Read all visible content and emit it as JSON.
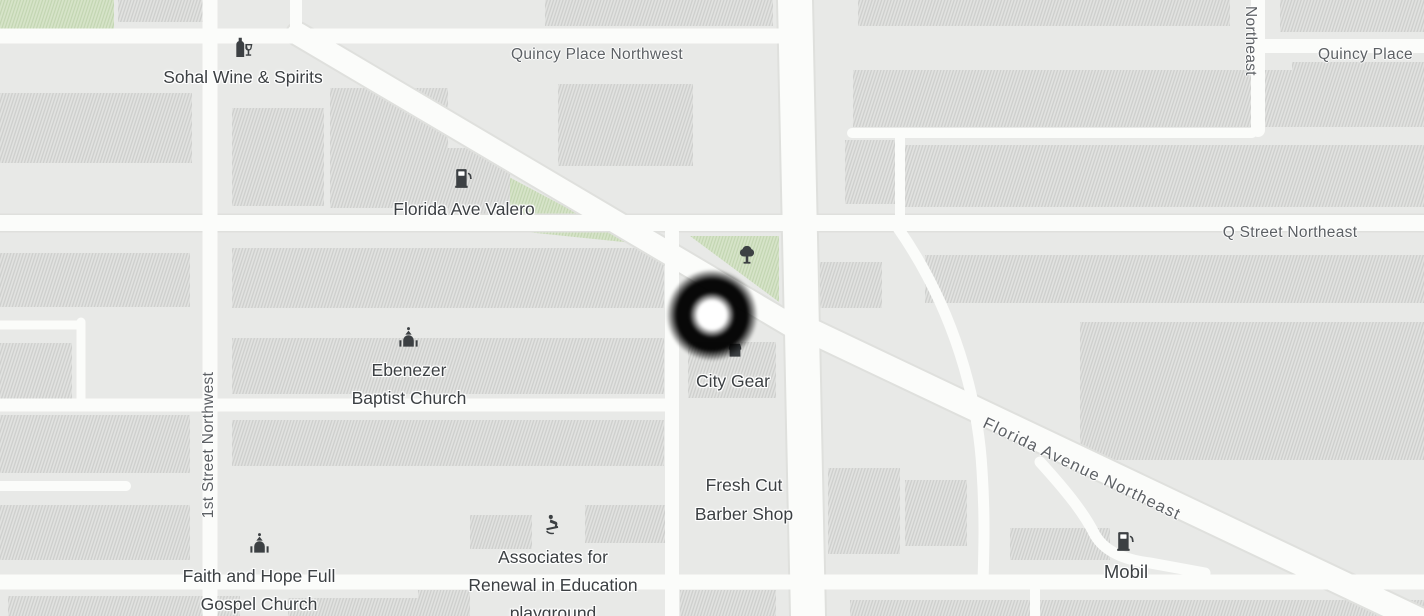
{
  "view": {
    "kind": "street-map"
  },
  "colors": {
    "background": "#e8e9e7",
    "block_fill": "#e2e3e1",
    "block_hatch": "#cdcecc",
    "road_fill": "#fbfcfa",
    "road_casing": "#dfe0dd",
    "park_fill": "#d7e4c9",
    "park_hatch": "#c2d5b1",
    "poi_text": "#3c4043",
    "street_text": "#5c6064",
    "icon_color": "#3c4043",
    "marker_ring": "#000000",
    "marker_center": "#ffffff"
  },
  "pois": {
    "sohal": {
      "label": "Sohal Wine & Spirits",
      "icon": "wine"
    },
    "valero": {
      "label": "Florida Ave Valero",
      "icon": "gas-pump"
    },
    "ebenezer": {
      "line1": "Ebenezer",
      "line2": "Baptist Church",
      "icon": "church"
    },
    "city_gear": {
      "label": "City Gear",
      "icon": "store"
    },
    "fresh_cut": {
      "line1": "Fresh Cut",
      "line2": "Barber Shop"
    },
    "faith": {
      "line1": "Faith and Hope Full",
      "line2": "Gospel Church",
      "icon": "church"
    },
    "associates": {
      "line1": "Associates for",
      "line2": "Renewal in Education",
      "line3": "playground",
      "icon": "playground"
    },
    "mobil": {
      "label": "Mobil",
      "icon": "gas-pump"
    },
    "park": {
      "icon": "tree"
    }
  },
  "streets": {
    "quincy_nw": "Quincy Place Northwest",
    "quincy_ne": "Quincy Place",
    "northeast_vertical": "Northeast",
    "q_street": "Q Street Northeast",
    "first_street": "1st Street Northwest",
    "florida_ave_ne": "Florida Avenue Northeast"
  },
  "marker": {
    "kind": "cursor-ring-marker"
  }
}
